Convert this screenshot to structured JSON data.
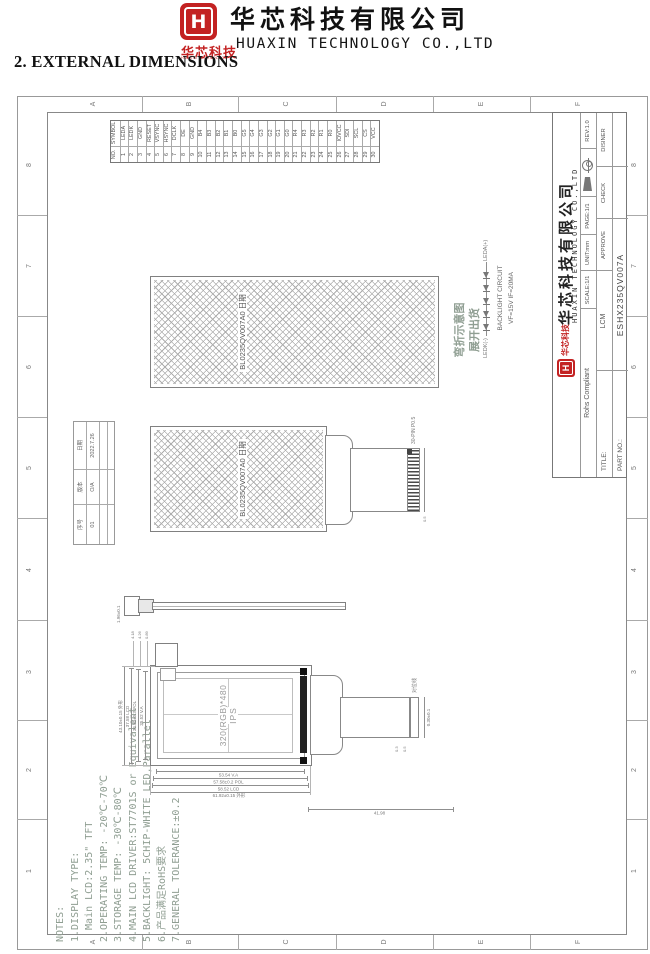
{
  "header": {
    "logo_letter": "H",
    "company_cn": "华芯科技有限公司",
    "company_en": "HUAXIN TECHNOLOGY CO.,LTD",
    "logo_sub_cn": "华芯科技",
    "logo_sub_en": "HUAXIN TECHNOLOGY",
    "section_title": "2. EXTERNAL DIMENSIONS"
  },
  "sheet": {
    "zone_letters": [
      "A",
      "B",
      "C",
      "D",
      "E",
      "F"
    ],
    "zone_numbers": [
      "1",
      "2",
      "3",
      "4",
      "5",
      "6",
      "7",
      "8"
    ]
  },
  "notes": {
    "lines": [
      "NOTES:",
      "1.DISPLAY TYPE:",
      "  Main LCD:2.35\" TFT",
      "2.OPERATING TEMP: -20℃-70℃",
      "3.STORAGE TEMP: -30℃-80℃",
      "4.MAIN LCD DRIVER:ST7701S or Equivalent",
      "5.BACKLIGHT: 5CHIP-WHITE LED,Parallel",
      "6.产品满足RoHS要求",
      "7.GENERAL TOLERANCE:±0.2"
    ]
  },
  "revision_table": {
    "header_row": [
      "序号",
      "版本",
      "日期"
    ],
    "value_row": [
      "01",
      "O/A",
      "2022.7.26"
    ]
  },
  "pin_table": {
    "no_label": "NO.",
    "symbol_label": "SYMBOL",
    "pins": [
      {
        "no": "1",
        "symbol": "LEDA"
      },
      {
        "no": "2",
        "symbol": "LEDK"
      },
      {
        "no": "3",
        "symbol": "GND"
      },
      {
        "no": "4",
        "symbol": "RESET"
      },
      {
        "no": "5",
        "symbol": "VSYNC"
      },
      {
        "no": "6",
        "symbol": "HSYNC"
      },
      {
        "no": "7",
        "symbol": "DCLK"
      },
      {
        "no": "8",
        "symbol": "DE"
      },
      {
        "no": "9",
        "symbol": "GND"
      },
      {
        "no": "10",
        "symbol": "B4"
      },
      {
        "no": "11",
        "symbol": "B3"
      },
      {
        "no": "12",
        "symbol": "B2"
      },
      {
        "no": "13",
        "symbol": "B1"
      },
      {
        "no": "14",
        "symbol": "B0"
      },
      {
        "no": "15",
        "symbol": "G5"
      },
      {
        "no": "16",
        "symbol": "G4"
      },
      {
        "no": "17",
        "symbol": "G3"
      },
      {
        "no": "18",
        "symbol": "G2"
      },
      {
        "no": "19",
        "symbol": "G1"
      },
      {
        "no": "20",
        "symbol": "G0"
      },
      {
        "no": "21",
        "symbol": "R4"
      },
      {
        "no": "22",
        "symbol": "R3"
      },
      {
        "no": "23",
        "symbol": "R2"
      },
      {
        "no": "24",
        "symbol": "R1"
      },
      {
        "no": "25",
        "symbol": "R0"
      },
      {
        "no": "26",
        "symbol": "IOVCC"
      },
      {
        "no": "27",
        "symbol": "SDI"
      },
      {
        "no": "28",
        "symbol": "SCL"
      },
      {
        "no": "29",
        "symbol": "CS"
      },
      {
        "no": "30",
        "symbol": "VCC"
      }
    ]
  },
  "title_block": {
    "company_cn": "华芯科技有限公司",
    "company_en": "HUAXIN TECHNOLOGY CO.,LTD",
    "logo_sub_cn": "华芯科技",
    "logo_letter": "H",
    "rohs": "Rohs Compliant",
    "scale": "SCALE:1/1",
    "unit": "UNIT:mm",
    "page": "PAGE:1/1",
    "rev": "REV:1.0",
    "title_label": "TITLE:",
    "title_value": "LCM",
    "approve": "APPROVE",
    "check": "CHECK",
    "designer": "DISINER",
    "part_label": "PART NO.:",
    "part_value": "ESHX235QV007A"
  },
  "views": {
    "front": {
      "aa_line1": "320(RGB)*480",
      "aa_line2": "IPS"
    },
    "flat_film_label": "BL0235QV007A0 日期",
    "bent_film_label": "BL0235QV007A0 日期",
    "bend_caption_line1": "弯折示意图",
    "bend_caption_line2": "展开出货",
    "circuit": {
      "anode": "LEDA(+)",
      "cathode": "LEDK(-)",
      "line1": "BACKLIGHT CIRCUIT",
      "line2": "VF=15V IF=20MA"
    }
  },
  "dims": {
    "width_dims": [
      "43.10±0.15 外形",
      "37.58 LCD",
      "36.80±0.3 POL",
      "35.52 V.A"
    ],
    "height_dims": [
      "61.92±0.15 外形",
      "58.52 LCD",
      "57.58±0.2 POL",
      "53.54 V.A"
    ],
    "fpc_length": "41.98",
    "protrusion_dims": [
      "4.18",
      "4.26",
      "0.89"
    ],
    "connector_front_dim": "0.30±0.1",
    "connector_small_dims": [
      "0.3",
      "0.5"
    ],
    "flat_connector_label": "30-PIN P0.5",
    "flat_connector_small": "0.5",
    "side_thickness": "1.96±0.1",
    "align_mark_label": "对位线"
  },
  "colors": {
    "accent_red": "#c32222",
    "line_gray": "#8a8a8a",
    "note_green": "#8f9e92"
  }
}
